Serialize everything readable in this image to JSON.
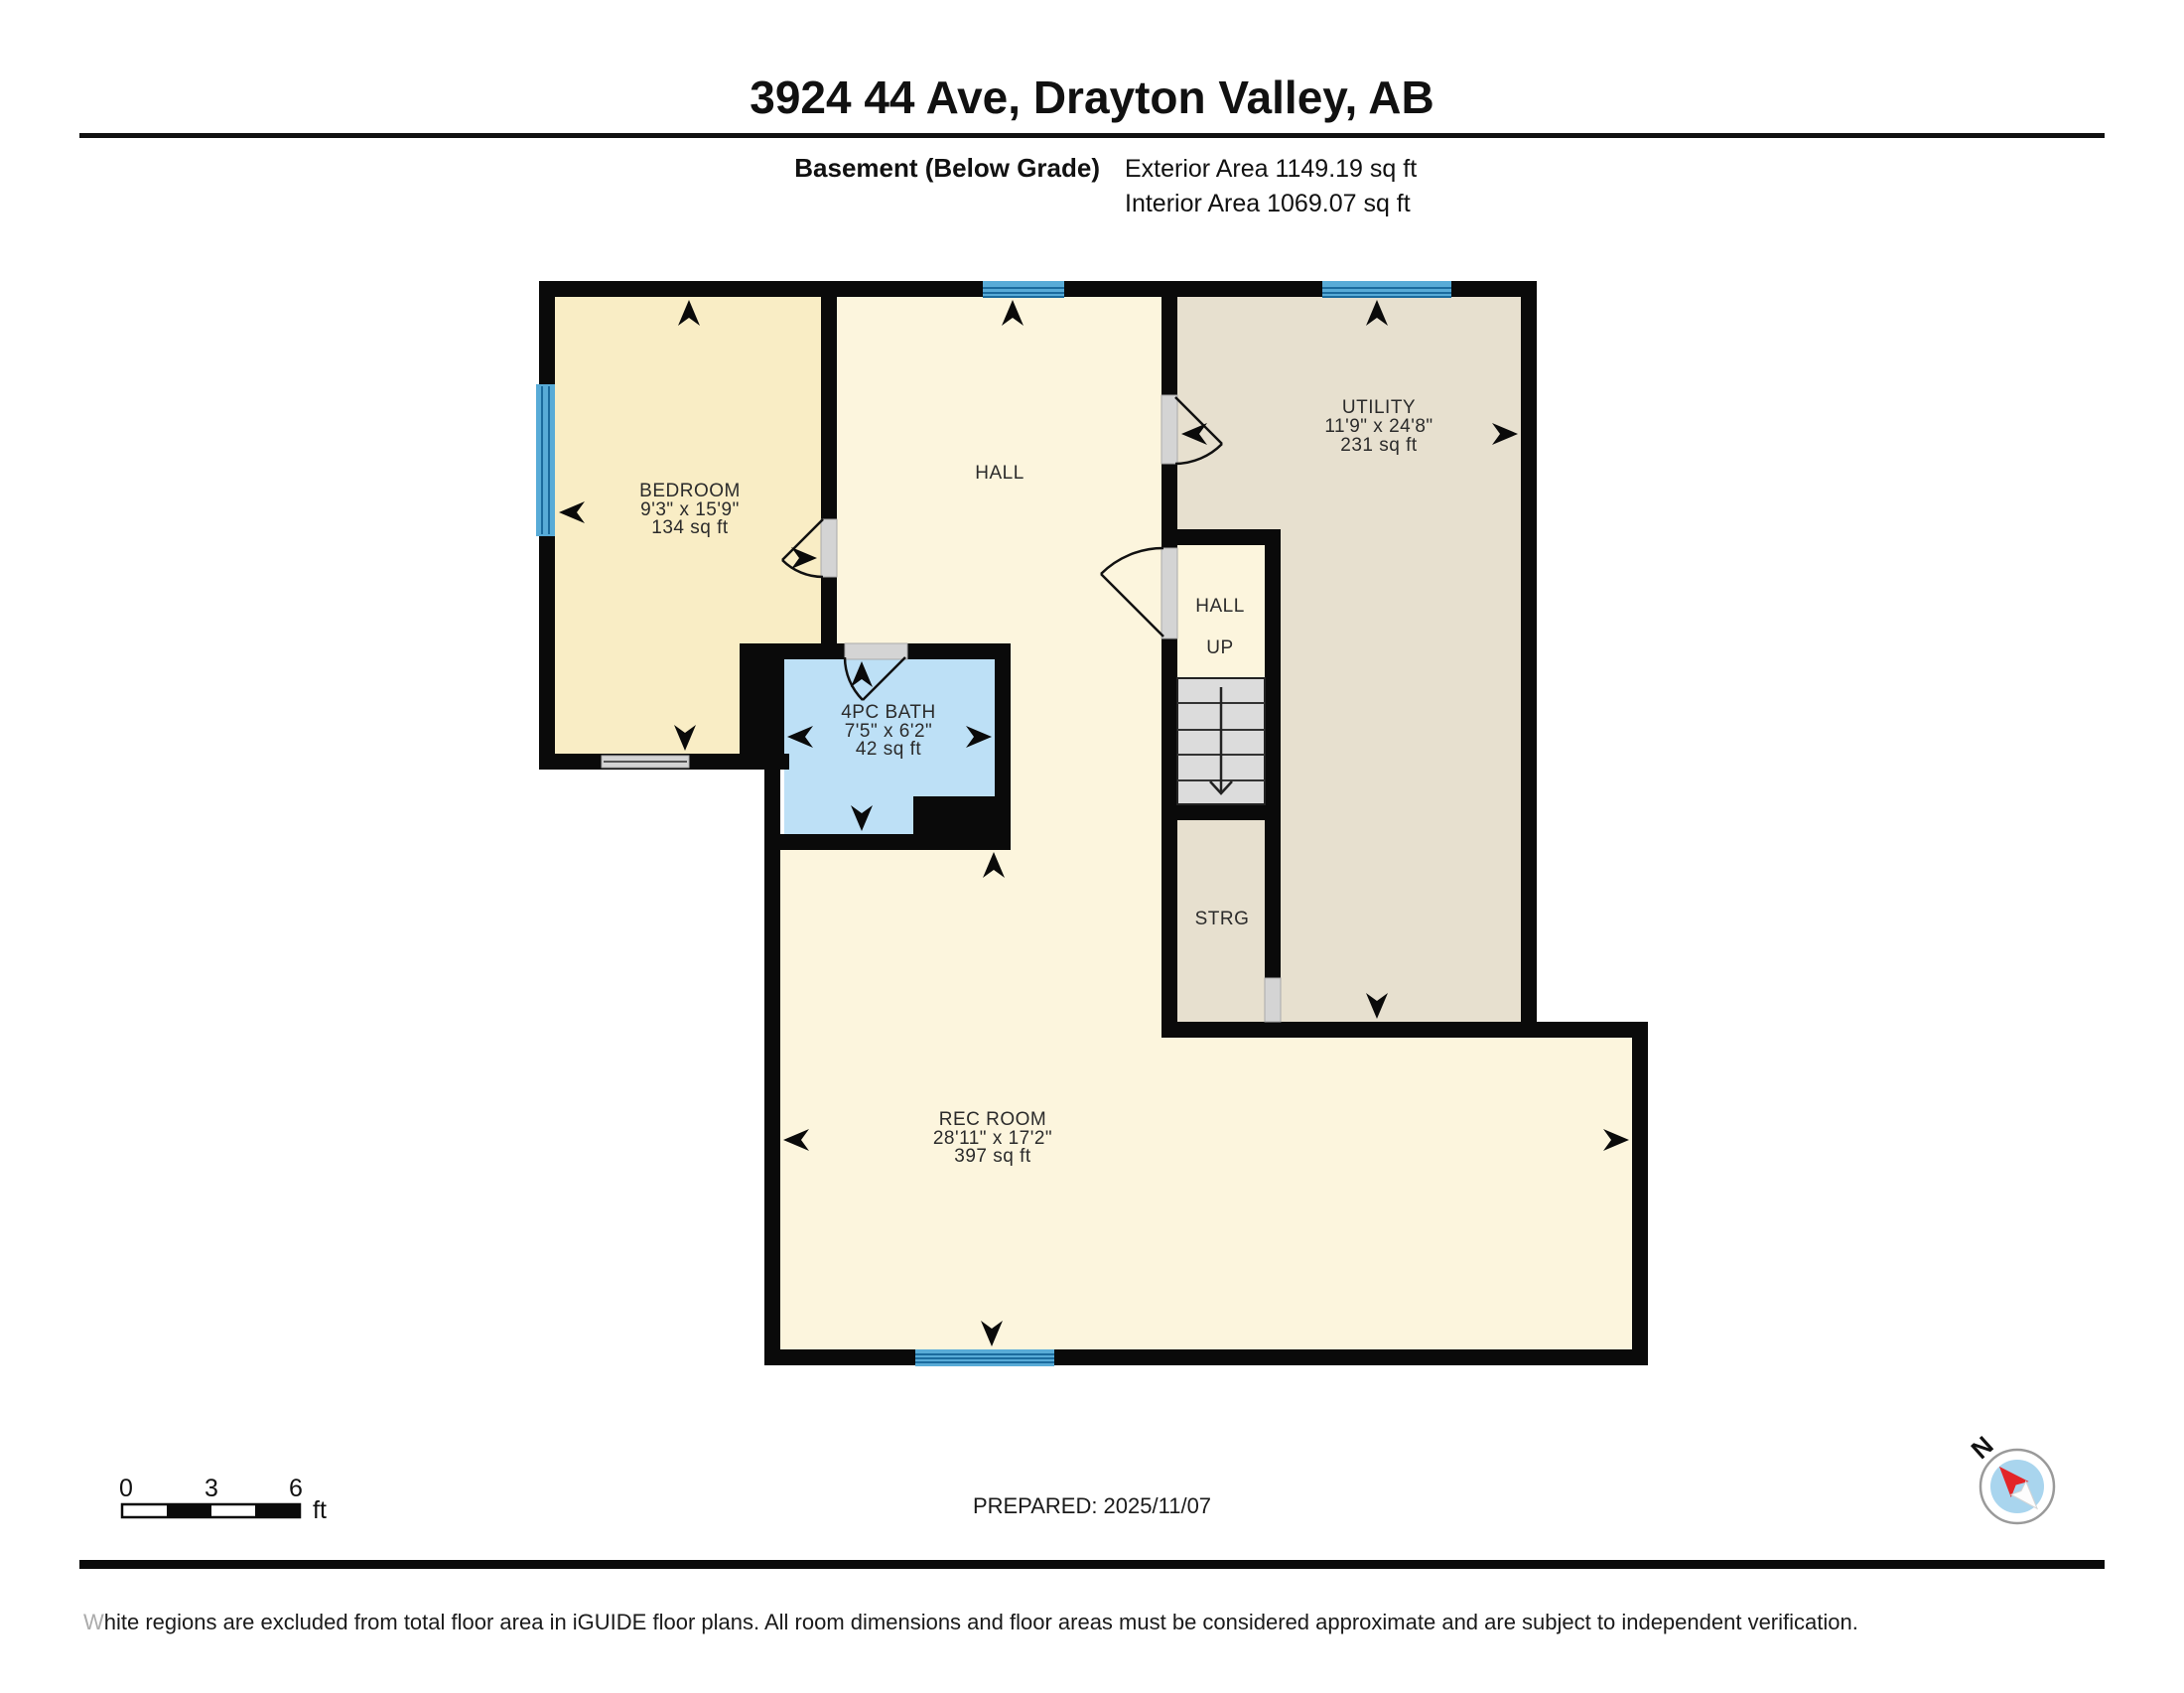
{
  "header": {
    "title": "3924 44 Ave, Drayton Valley, AB",
    "floor_label": "Basement (Below Grade)",
    "exterior_area": "Exterior Area 1149.19 sq ft",
    "interior_area": "Interior Area 1069.07 sq ft"
  },
  "rooms": {
    "bedroom": {
      "name": "BEDROOM",
      "dims": "9'3\" x 15'9\"",
      "area": "134 sq ft"
    },
    "hall": {
      "name": "HALL"
    },
    "utility": {
      "name": "UTILITY",
      "dims": "11'9\" x 24'8\"",
      "area": "231 sq ft"
    },
    "bath": {
      "name": "4PC BATH",
      "dims": "7'5\" x 6'2\"",
      "area": "42 sq ft"
    },
    "hall_up": {
      "name": "HALL",
      "direction": "UP"
    },
    "storage": {
      "name": "STRG"
    },
    "rec_room": {
      "name": "REC ROOM",
      "dims": "28'11\" x 17'2\"",
      "area": "397 sq ft"
    }
  },
  "scale_bar": {
    "start": "0",
    "mid": "3",
    "end": "6",
    "unit": "ft"
  },
  "prepared": {
    "label": "PREPARED: 2025/11/07"
  },
  "compass": {
    "north": "N"
  },
  "disclaimer": {
    "lead": "W",
    "rest": "hite regions are excluded from total floor area in iGUIDE floor plans. All room dimensions and floor areas must be considered approximate and are subject to independent verification."
  },
  "colors": {
    "wall": "#0a0a0a",
    "bedroom": "#F9EDC5",
    "hall": "#FCF5DD",
    "utility": "#E7E0CF",
    "bath": "#BDE0F6",
    "stairs": "#DCDCDC",
    "window": "#58ABD7",
    "window_line": "#1B6B9E",
    "sill": "#D4D4D4",
    "needle_red": "#E32528",
    "compass_inner": "#A9D5EE"
  }
}
